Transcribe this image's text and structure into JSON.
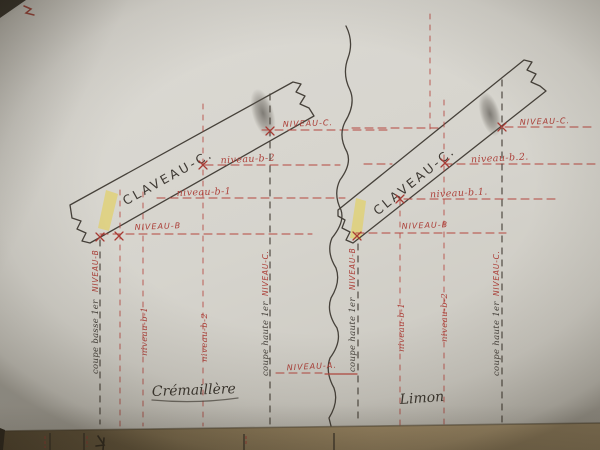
{
  "colors": {
    "paper": "#d6d4cd",
    "red_ink": "#ad423b",
    "dark_ink": "#46413a",
    "yellow_highlight": "#e6cf4b",
    "table_wood": "#a8926c"
  },
  "left_diagram": {
    "claveau_label": "CLAVEAU-C.",
    "caption": "Crémaillère",
    "levels": {
      "niveau_c": "NIVEAU-C.",
      "niveau_b2": "niveau-b-2",
      "niveau_b1": "niveau-b-1",
      "niveau_b": "NIVEAU-B"
    },
    "cuts": {
      "low_cut_ink": "coupe basse 1er",
      "low_cut_red": "NIVEAU-B",
      "proj_b1": "niveau-b-1",
      "proj_b2": "niveau-b-2",
      "high_cut_ink": "coupe haute 1er",
      "high_cut_red": "NIVEAU-C."
    }
  },
  "right_diagram": {
    "claveau_label": "CLAVEAU-C.",
    "caption": "Limon",
    "levels": {
      "niveau_c": "NIVEAU-C.",
      "niveau_b2": "niveau-b.2.",
      "niveau_b1": "niveau-b.1.",
      "niveau_b": "NIVEAU-B"
    },
    "cuts": {
      "low_cut_ink": "coupe haute 1er",
      "low_cut_red": "NIVEAU-B",
      "proj_b1": "niveau-b-1",
      "proj_b2": "niveau-b-2",
      "high_cut_ink": "coupe haute 1er",
      "high_cut_red": "NIVEAU-C."
    }
  },
  "break_line": {
    "label": "NIVEAU-A."
  }
}
